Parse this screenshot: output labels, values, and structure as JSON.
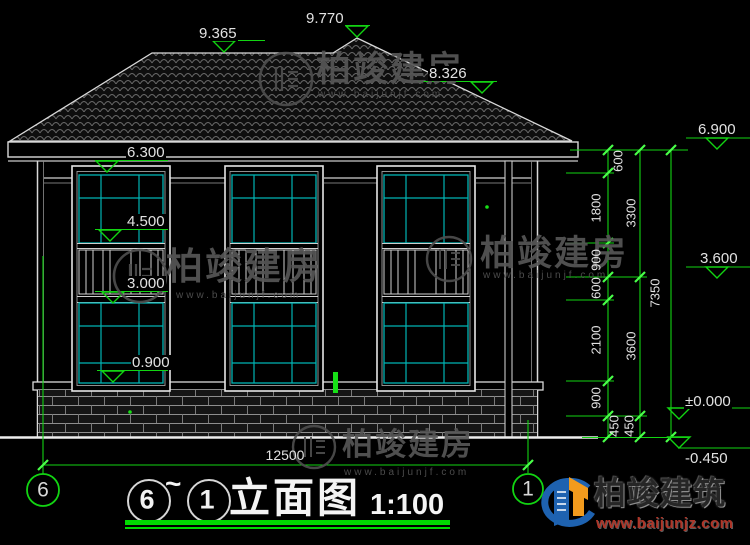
{
  "title": {
    "from": "6",
    "tilde": "~",
    "to": "1",
    "name": "立面图",
    "scale": "1:100"
  },
  "axes": {
    "left": "6",
    "right": "1"
  },
  "levels": {
    "roof_hip": "9.365",
    "roof_peak": "9.770",
    "roof_slope": "8.326",
    "upper_window_head": "6.300",
    "upper_window_sill": "4.500",
    "lower_window_head": "3.000",
    "lower_window_sill": "0.900",
    "eave": "6.900",
    "mid": "3.600",
    "zero": "±0.000",
    "grade": "-0.450"
  },
  "dims": {
    "v1_600_top": "600",
    "v1_1800": "1800",
    "v1_900_up": "900",
    "v1_600_mid": "600",
    "v1_2100": "2100",
    "v1_900_low": "900",
    "v1_450": "450",
    "v2_3300": "3300",
    "v2_3600": "3600",
    "v2_450": "450",
    "v_total": "7350",
    "h_total": "12500"
  },
  "watermark": {
    "brand": "柏竣建房",
    "url": "www.baijunjf.com"
  },
  "logo": {
    "brand": "柏竣建筑",
    "url": "www.baijunjz.com"
  },
  "colors": {
    "dim_green": "#12D412",
    "glass_cyan": "#00B4B4",
    "line_white": "#D9D9D9",
    "logo_blue": "#1E62B0",
    "logo_orange": "#F29B1D"
  }
}
